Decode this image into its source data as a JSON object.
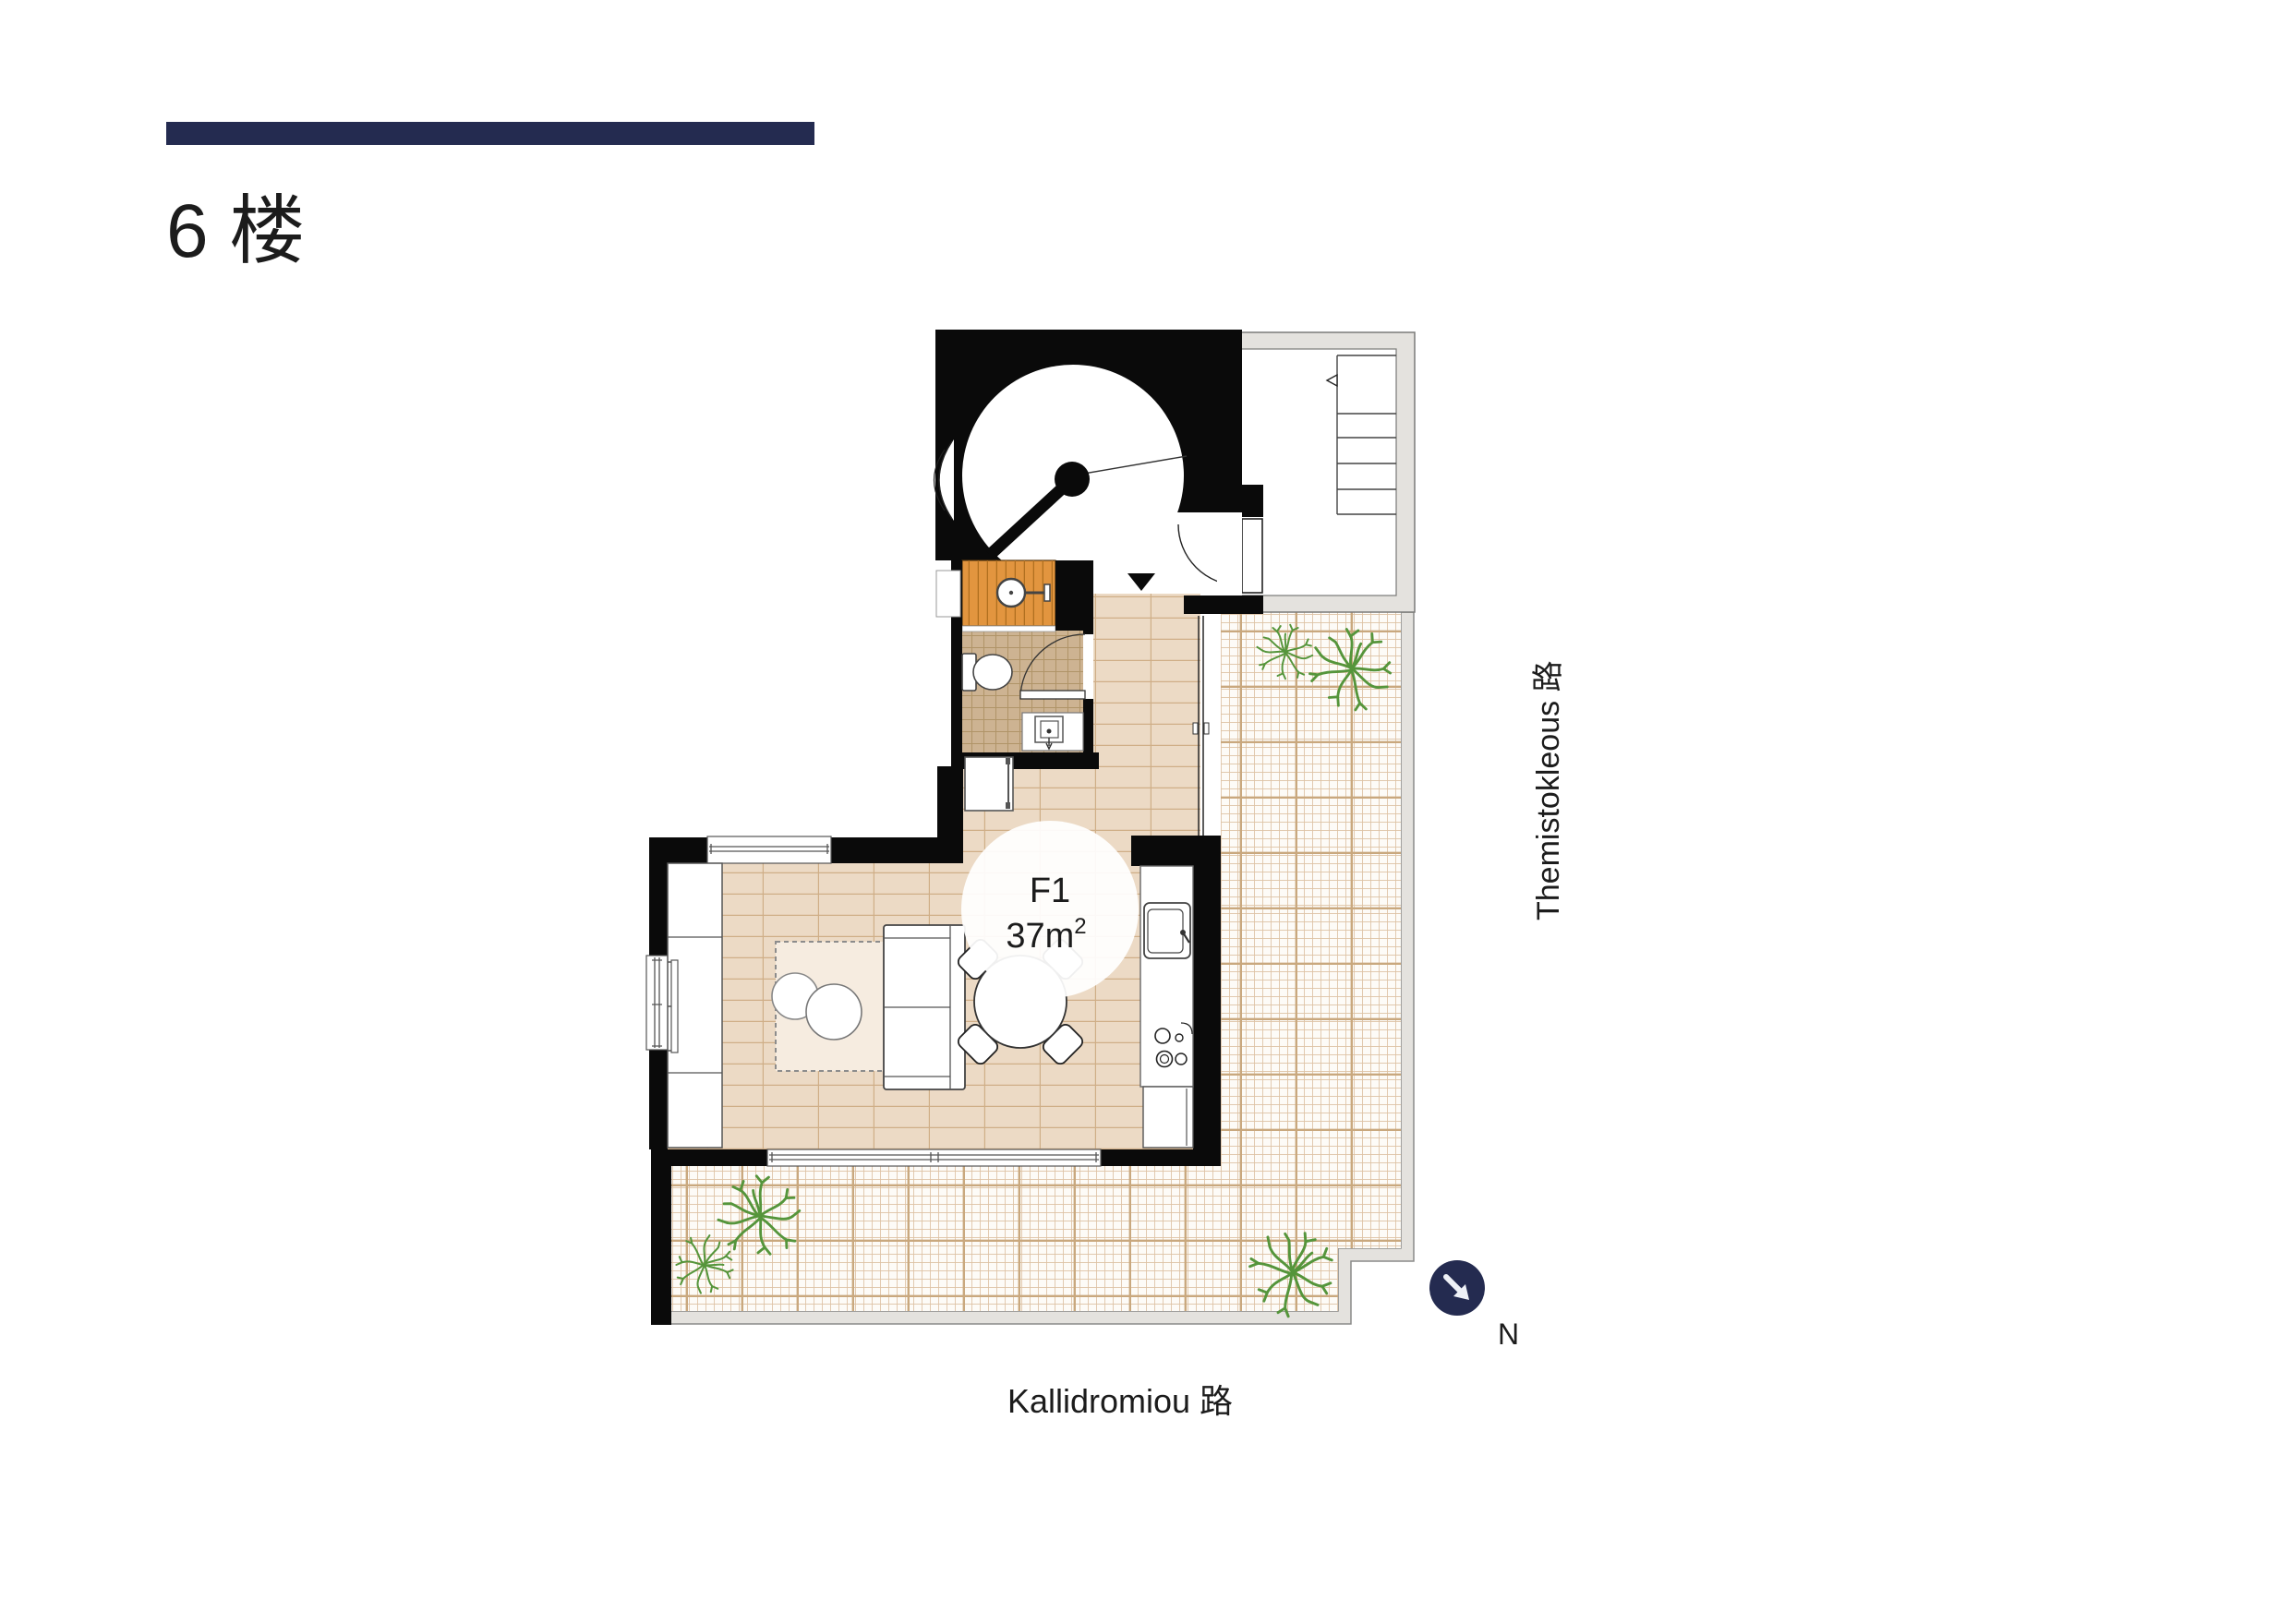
{
  "header": {
    "floor_title": "6 楼",
    "accent_bar_color": "#242b50"
  },
  "unit": {
    "label": "F1",
    "area_base": "37m",
    "area_exp": "2"
  },
  "streets": {
    "right": "Themistokleous 路",
    "bottom": "Kallidromiou 路"
  },
  "compass": {
    "label": "N",
    "color": "#242b50"
  },
  "palette": {
    "wall": "#0a0a0a",
    "main_floor": "#ecdac5",
    "main_floor_line": "#cfae87",
    "bath_floor": "#cdb392",
    "bath_floor_line": "#b09468",
    "shower_floor": "#e2953f",
    "shower_floor_line": "#b06f1f",
    "terrace_base": "#fdfbf7",
    "terrace_line": "#ddc2a4",
    "terrace_accent": "#c9a87e",
    "surround_gray": "#e4e2de",
    "plant_green": "#55953b",
    "rug": "#f6ece0"
  }
}
